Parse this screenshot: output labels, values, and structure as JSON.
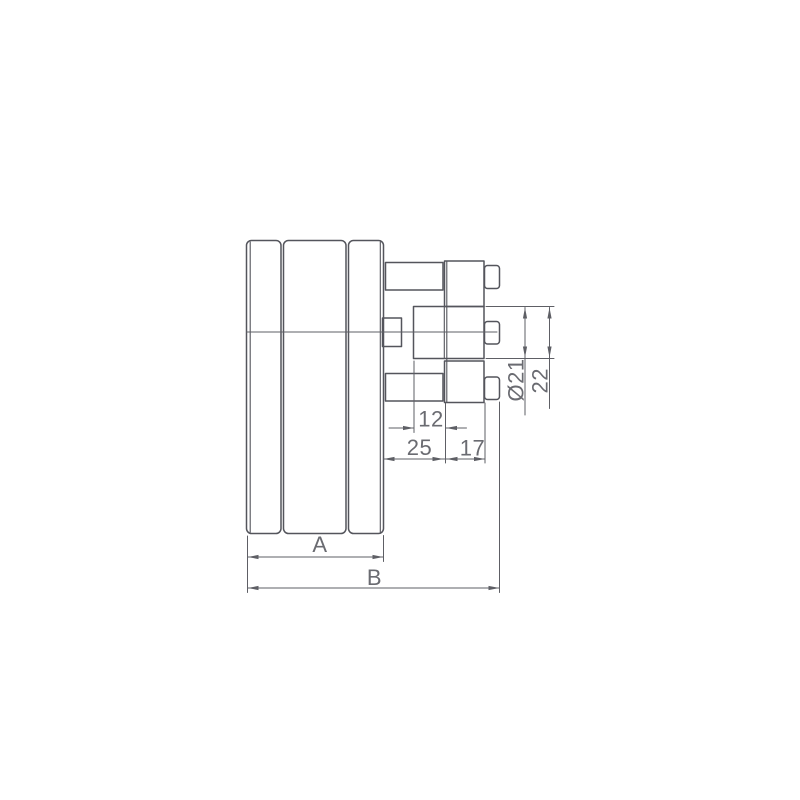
{
  "page": {
    "background_color": "#ffffff"
  },
  "drawing": {
    "part_stroke_color": "#54555c",
    "dimension_stroke_color": "#5e5f65",
    "label_color": "#6a6b71",
    "labels": {
      "dim_12": "12",
      "dim_25": "25",
      "dim_17": "17",
      "dim_dia21": "Ø21",
      "dim_22": "22",
      "dim_a": "A",
      "dim_b": "B"
    }
  }
}
